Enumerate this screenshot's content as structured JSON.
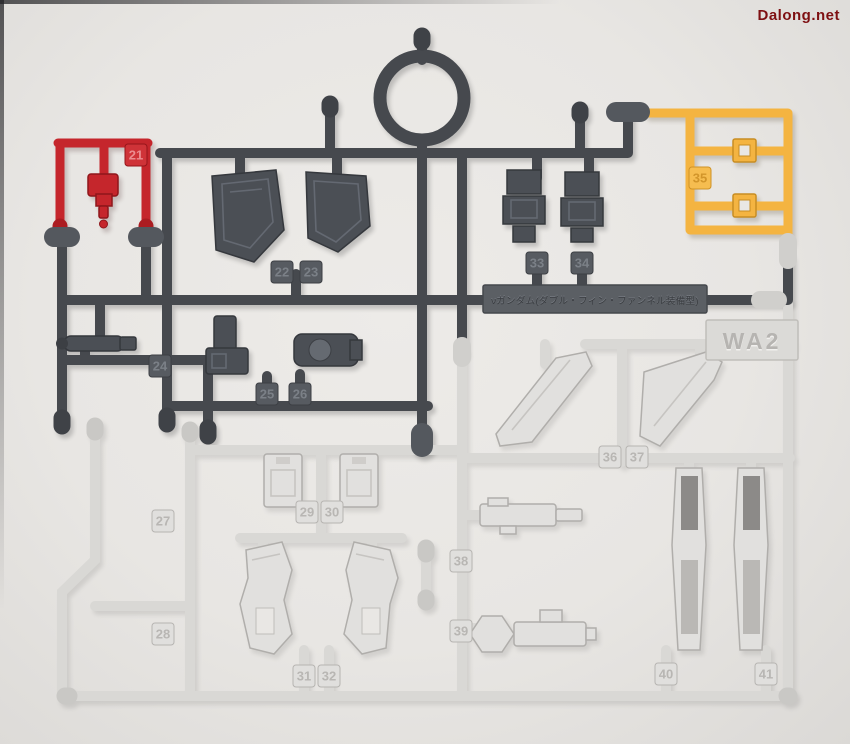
{
  "watermark": {
    "text": "Dalong.net",
    "color": "#7e1012"
  },
  "runner": {
    "name_plate": {
      "text": "νガンダム(ダブル・フィン・ファンネル装備型)"
    },
    "code_plate": {
      "text": "WA2"
    },
    "colors": {
      "dark_gray": "#46494e",
      "red": "#c5262c",
      "yellow": "#f4b441",
      "light_gray": "#dcdbd9",
      "background": "#e8e6e3",
      "watermark_red": "#7e1012"
    },
    "tags": [
      {
        "label": "21",
        "runner_color": "red"
      },
      {
        "label": "22",
        "runner_color": "dark_gray"
      },
      {
        "label": "23",
        "runner_color": "dark_gray"
      },
      {
        "label": "24",
        "runner_color": "dark_gray"
      },
      {
        "label": "25",
        "runner_color": "dark_gray"
      },
      {
        "label": "26",
        "runner_color": "dark_gray"
      },
      {
        "label": "27",
        "runner_color": "light_gray"
      },
      {
        "label": "28",
        "runner_color": "light_gray"
      },
      {
        "label": "29",
        "runner_color": "light_gray"
      },
      {
        "label": "30",
        "runner_color": "light_gray"
      },
      {
        "label": "31",
        "runner_color": "light_gray"
      },
      {
        "label": "32",
        "runner_color": "light_gray"
      },
      {
        "label": "33",
        "runner_color": "dark_gray"
      },
      {
        "label": "34",
        "runner_color": "dark_gray"
      },
      {
        "label": "35",
        "runner_color": "yellow"
      },
      {
        "label": "36",
        "runner_color": "light_gray"
      },
      {
        "label": "37",
        "runner_color": "light_gray"
      },
      {
        "label": "38",
        "runner_color": "light_gray"
      },
      {
        "label": "39",
        "runner_color": "light_gray"
      },
      {
        "label": "40",
        "runner_color": "light_gray"
      },
      {
        "label": "41",
        "runner_color": "light_gray"
      }
    ]
  }
}
